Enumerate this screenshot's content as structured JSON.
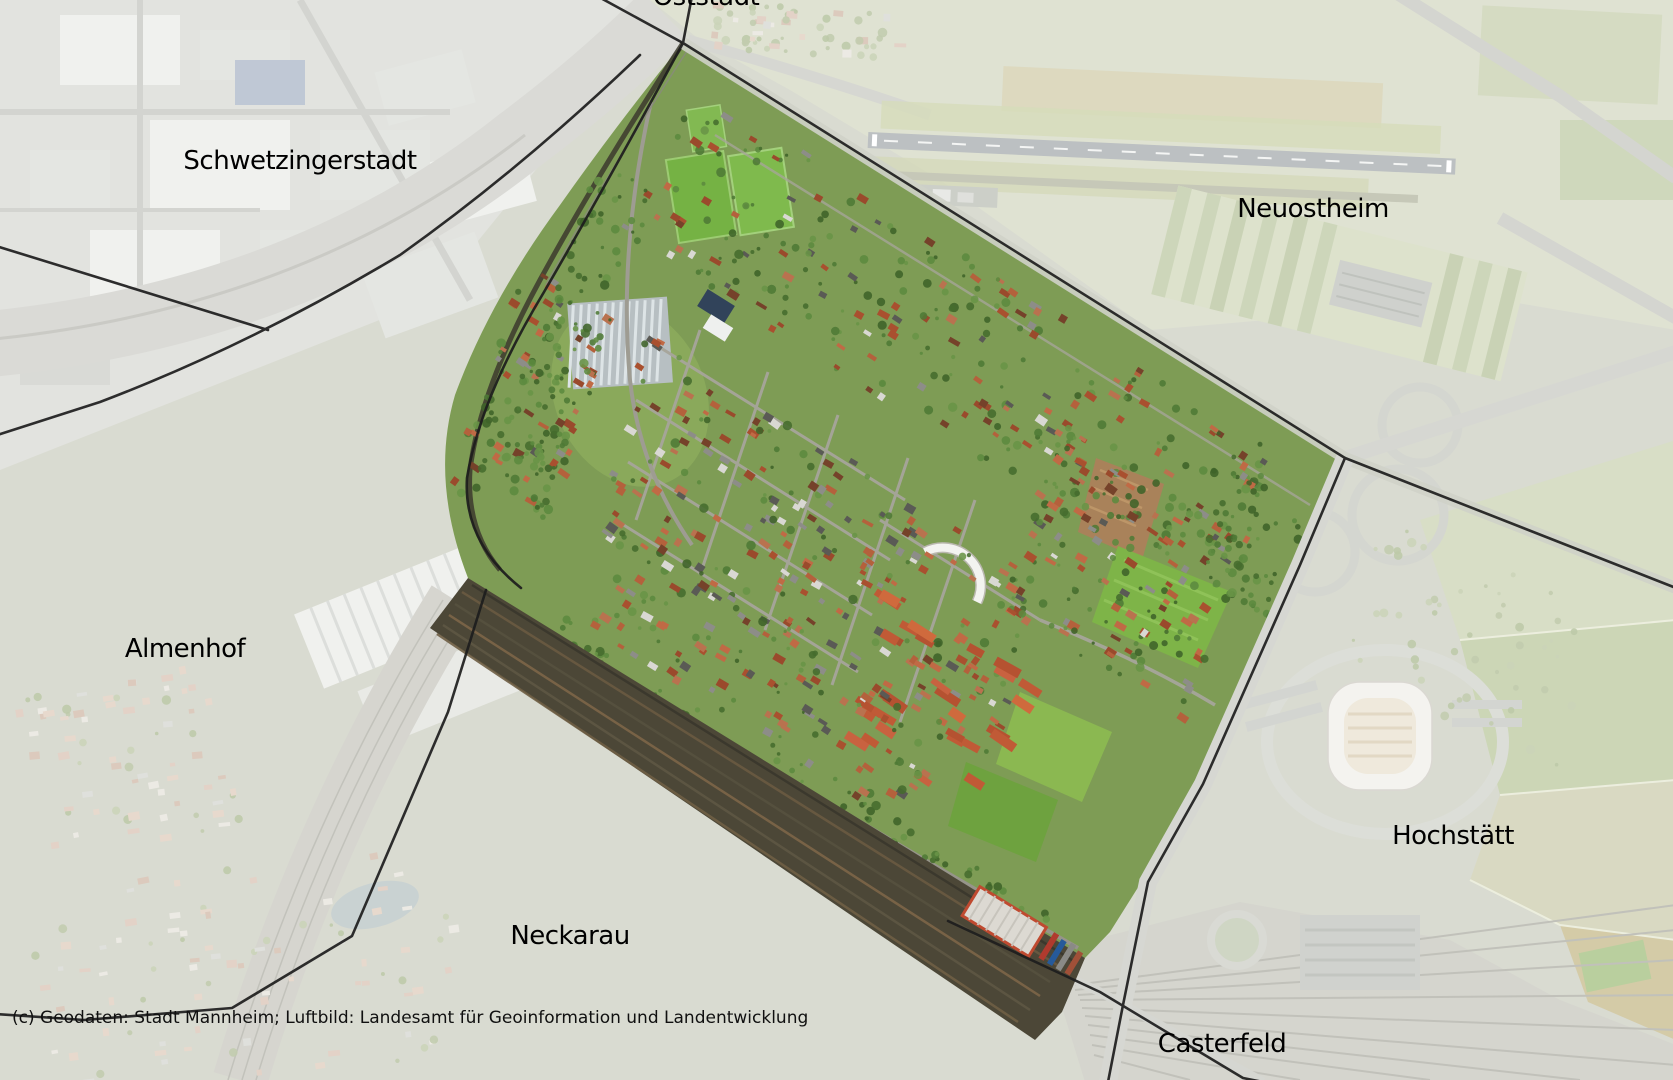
{
  "labels": [
    {
      "id": "oststadt",
      "text": "Oststadt"
    },
    {
      "id": "schwetzingerstadt",
      "text": "Schwetzingerstadt"
    },
    {
      "id": "neuostheim",
      "text": "Neuostheim"
    },
    {
      "id": "almenhof",
      "text": "Almenhof"
    },
    {
      "id": "neckarau",
      "text": "Neckarau"
    },
    {
      "id": "hochstaett",
      "text": "Hochstätt"
    },
    {
      "id": "casterfeld",
      "text": "Casterfeld"
    }
  ],
  "attribution": "(c) Geodaten: Stadt Mannheim; Luftbild: Landesamt für Geoinformation und Landentwicklung",
  "colors": {
    "boundary_line": "#1d1d1d",
    "district_base": "#7e9c55",
    "washed_base": "#d9dbd1",
    "rail_dark": "#4c4737",
    "label_text": "#000000"
  }
}
